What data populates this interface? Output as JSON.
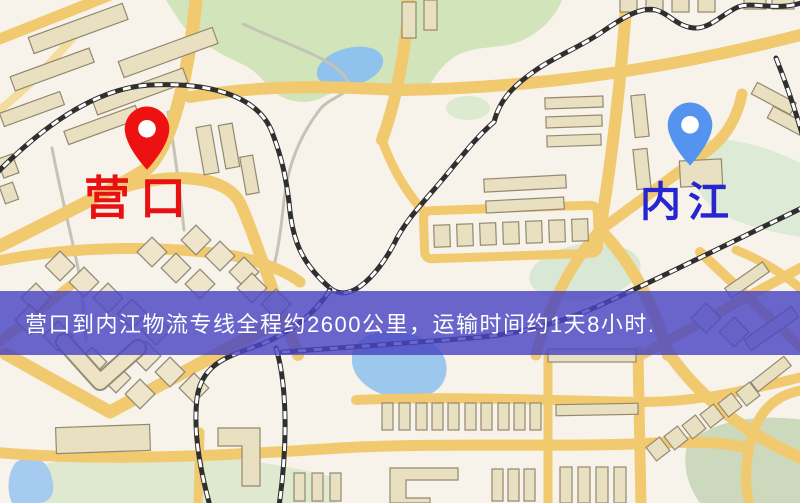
{
  "map": {
    "origin": {
      "label": "营口",
      "label_color": "#e81010",
      "pin_color": "#ee1111",
      "pin_icon": "red-map-pin-icon"
    },
    "destination": {
      "label": "内江",
      "label_color": "#2525d2",
      "pin_color": "#5494ef",
      "pin_icon": "blue-map-pin-icon"
    },
    "banner": {
      "text": "营口到内江物流专线全程约2600公里，运输时间约1天8小时.",
      "overlay_color": "rgba(73,69,197,0.82)",
      "text_color": "#ffffff"
    },
    "palette": {
      "background": "#f7f2ea",
      "road": "#f1c96f",
      "building": "#e9dfc1",
      "park": "#d2e4ba",
      "water": "#9cc8ee",
      "railway": "#2f2f2f"
    }
  }
}
